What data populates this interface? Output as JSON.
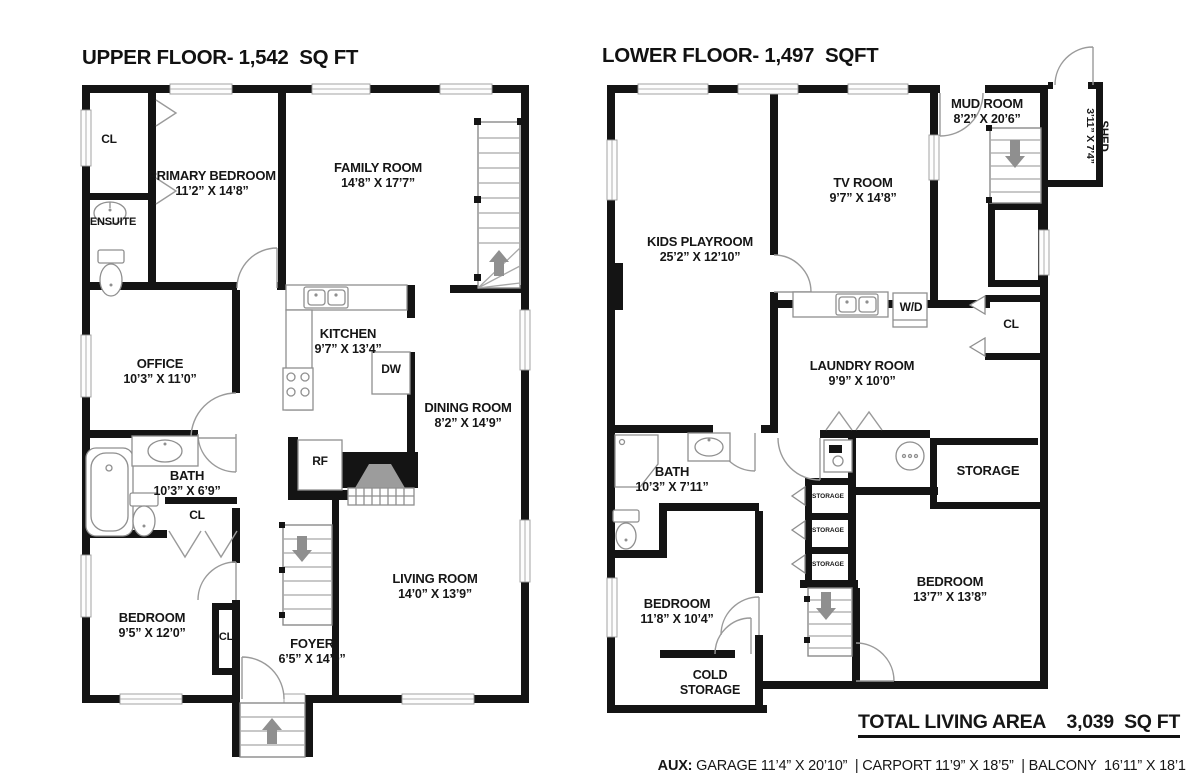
{
  "upper": {
    "title": "UPPER FLOOR- 1,542  SQ FT",
    "rooms": {
      "closet_top": {
        "name": "CL"
      },
      "primary_bedroom": {
        "name": "PRIMARY BEDROOM",
        "dims": "11’2” X 14’8”"
      },
      "ensuite": {
        "name": "ENSUITE"
      },
      "family_room": {
        "name": "FAMILY ROOM",
        "dims": "14’8” X 17’7”"
      },
      "office": {
        "name": "OFFICE",
        "dims": "10’3” X 11’0”"
      },
      "kitchen": {
        "name": "KITCHEN",
        "dims": "9’7” X 13’4”"
      },
      "dishwasher": {
        "name": "DW"
      },
      "dining_room": {
        "name": "DINING ROOM",
        "dims": "8’2” X 14’9”"
      },
      "refrigerator": {
        "name": "RF"
      },
      "bath": {
        "name": "BATH",
        "dims": "10’3” X 6’9”"
      },
      "closet_bath": {
        "name": "CL"
      },
      "bedroom": {
        "name": "BEDROOM",
        "dims": "9’5” X 12’0”"
      },
      "closet_foyer": {
        "name": "CL"
      },
      "foyer": {
        "name": "FOYER",
        "dims": "6’5” X 14’0”"
      },
      "living_room": {
        "name": "LIVING ROOM",
        "dims": "14’0” X 13’9”"
      }
    }
  },
  "lower": {
    "title": "LOWER FLOOR- 1,497  SQFT",
    "rooms": {
      "kids_playroom": {
        "name": "KIDS PLAYROOM",
        "dims": "25’2” X 12’10”"
      },
      "tv_room": {
        "name": "TV ROOM",
        "dims": "9’7” X 14’8”"
      },
      "mud_room": {
        "name": "MUD ROOM",
        "dims": "8’2” X 20’6”"
      },
      "shed": {
        "name": "SHED",
        "dims": "3’11” X 7’4”"
      },
      "washer_dryer": {
        "name": "W/D"
      },
      "closet": {
        "name": "CL"
      },
      "laundry_room": {
        "name": "LAUNDRY ROOM",
        "dims": "9’9” X 10’0”"
      },
      "bath": {
        "name": "BATH",
        "dims": "10’3” X 7’11”"
      },
      "storage_room": {
        "name": "STORAGE"
      },
      "storage_closet_1": {
        "name": "STORAGE"
      },
      "storage_closet_2": {
        "name": "STORAGE"
      },
      "storage_closet_3": {
        "name": "STORAGE"
      },
      "bedroom_right": {
        "name": "BEDROOM",
        "dims": "13’7” X 13’8”"
      },
      "bedroom_left": {
        "name": "BEDROOM",
        "dims": "11’8” X 10’4”"
      },
      "cold_storage": {
        "name": "COLD STORAGE"
      }
    }
  },
  "footer": {
    "total_label": "TOTAL LIVING AREA",
    "total_value": "3,039  SQ FT",
    "aux_label": "AUX:",
    "aux_text": " GARAGE 11’4” X 20’10”  | CARPORT 11’9” X 18’5”  | BALCONY  16’11” X 18’1"
  }
}
